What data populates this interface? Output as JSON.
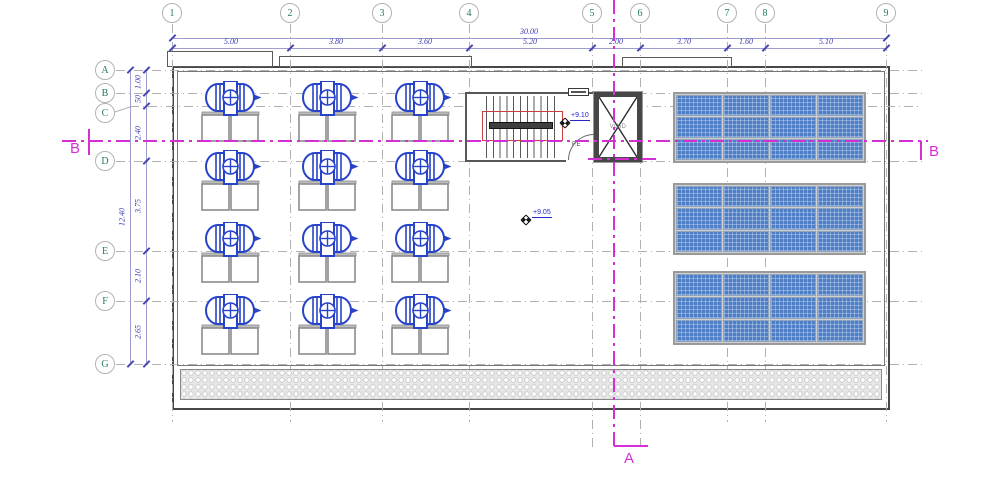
{
  "grid": {
    "cols": [
      "1",
      "2",
      "3",
      "4",
      "5",
      "6",
      "7",
      "8",
      "9"
    ],
    "rows": [
      "A",
      "B",
      "C",
      "D",
      "E",
      "F",
      "G"
    ]
  },
  "dimensions": {
    "h_total": "30.00",
    "h": [
      "5.00",
      "3.80",
      "3.60",
      "5.20",
      "2.00",
      "3.70",
      "1.60",
      "5.10"
    ],
    "v_total": "12.40",
    "v": [
      "1.00",
      "50",
      "2.40",
      "3.75",
      "2.10",
      "2.65"
    ]
  },
  "sections": {
    "b_left": "B",
    "b_right": "B",
    "a_bottom": "A"
  },
  "annotations": {
    "stair_level": "+9.10",
    "roof_level": "+9.05",
    "elevator": "VOID",
    "door": "F.E"
  },
  "colors": {
    "tank_blue": "#2743c9",
    "panel_blue": "#4d7ec6",
    "section_magenta": "#d42fd4",
    "dimension_text": "#3c3cb4",
    "grid_bubble_text": "#267a62",
    "stair_opening_red": "#c84040",
    "wall_gray": "#474747"
  }
}
